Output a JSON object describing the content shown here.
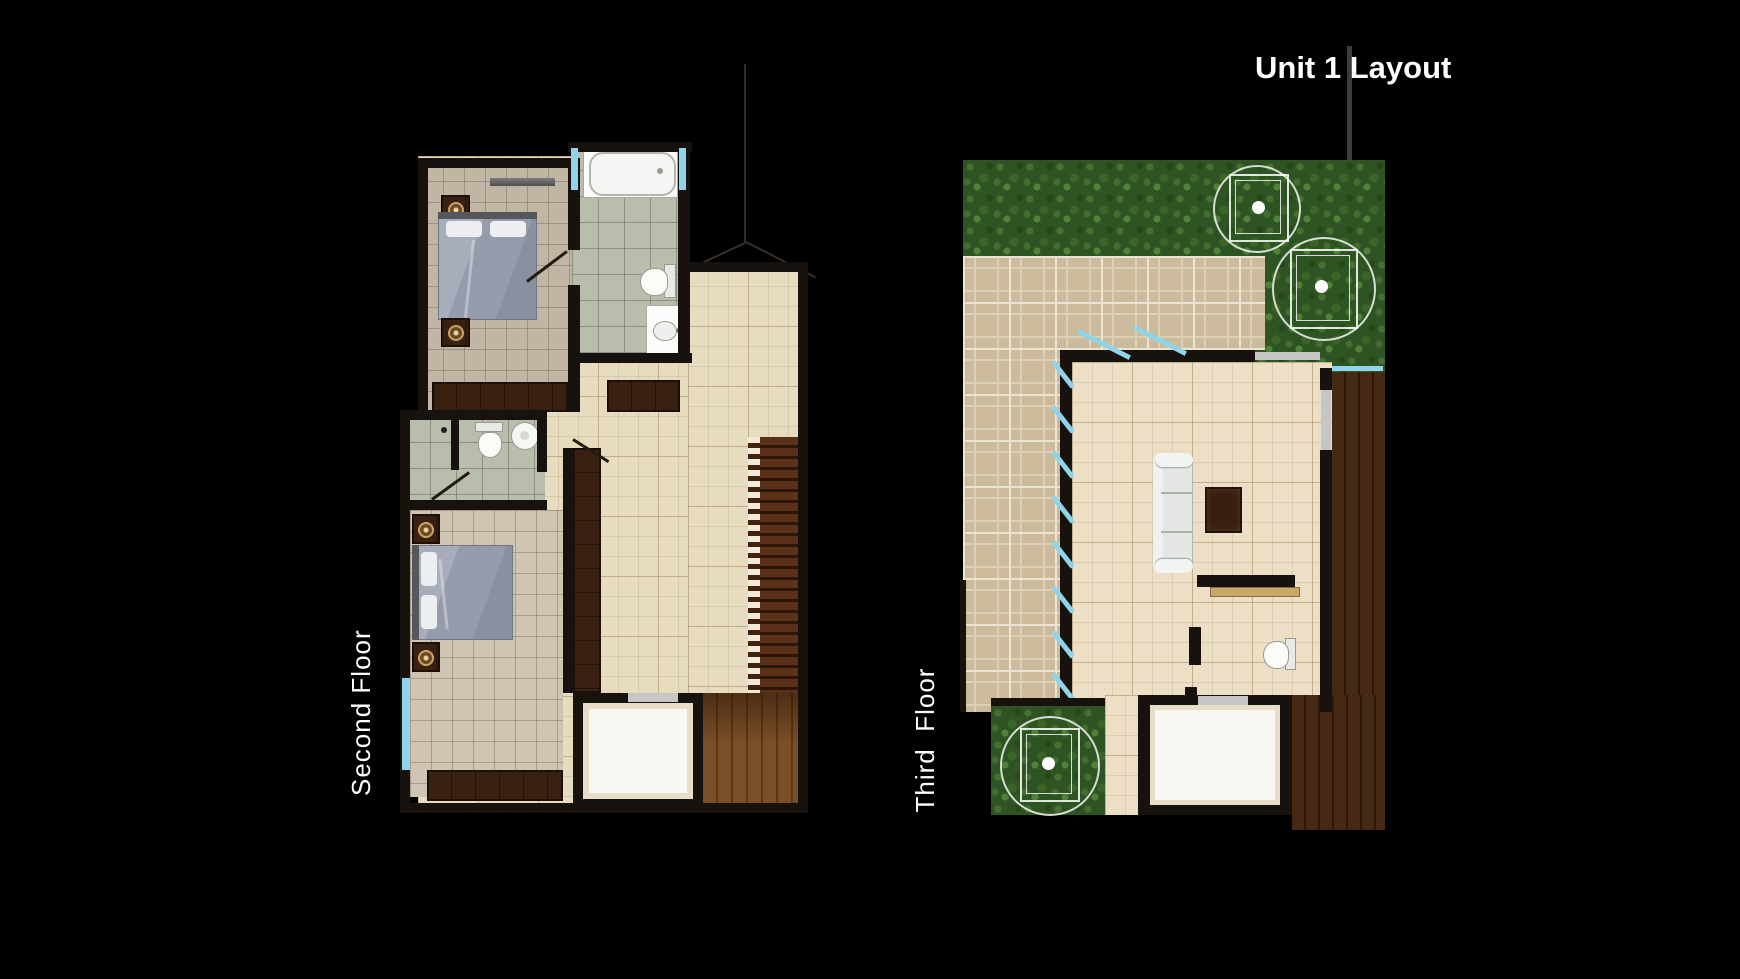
{
  "title": "Unit 1 Layout",
  "plans": {
    "second_floor": {
      "label": "Second Floor",
      "icons": [
        "bed-icon",
        "nightstand-icon",
        "wall-shelf-icon",
        "bathtub-icon",
        "toilet-icon",
        "sink-icon",
        "wardrobe-icon",
        "dresser-icon",
        "stairs-icon",
        "window-icon",
        "door-swing-icon",
        "landing-room",
        "wood-floor",
        "roofline"
      ]
    },
    "third_floor": {
      "label": "Third  Floor",
      "icons": [
        "hedge",
        "tree-icon",
        "paver-terrace",
        "sofa-icon",
        "rug-icon",
        "console-shelf-icon",
        "toilet-icon",
        "planter",
        "wood-deck",
        "window-icon",
        "sliding-door-icon",
        "landing-room"
      ]
    }
  },
  "colors": {
    "background": "#000000",
    "wall": "#17120d",
    "tile_cream": "#e8dcc0",
    "tile_bedroom": "#cfc5b2",
    "tile_bath": "#b9bdab",
    "hedge_green": "#2f5423",
    "paver_tan": "#ccba9d",
    "wood_brown": "#5e3514",
    "deck_brown": "#2d1708",
    "window_cyan": "#8fd4e8",
    "label_white": "#ffffff"
  }
}
